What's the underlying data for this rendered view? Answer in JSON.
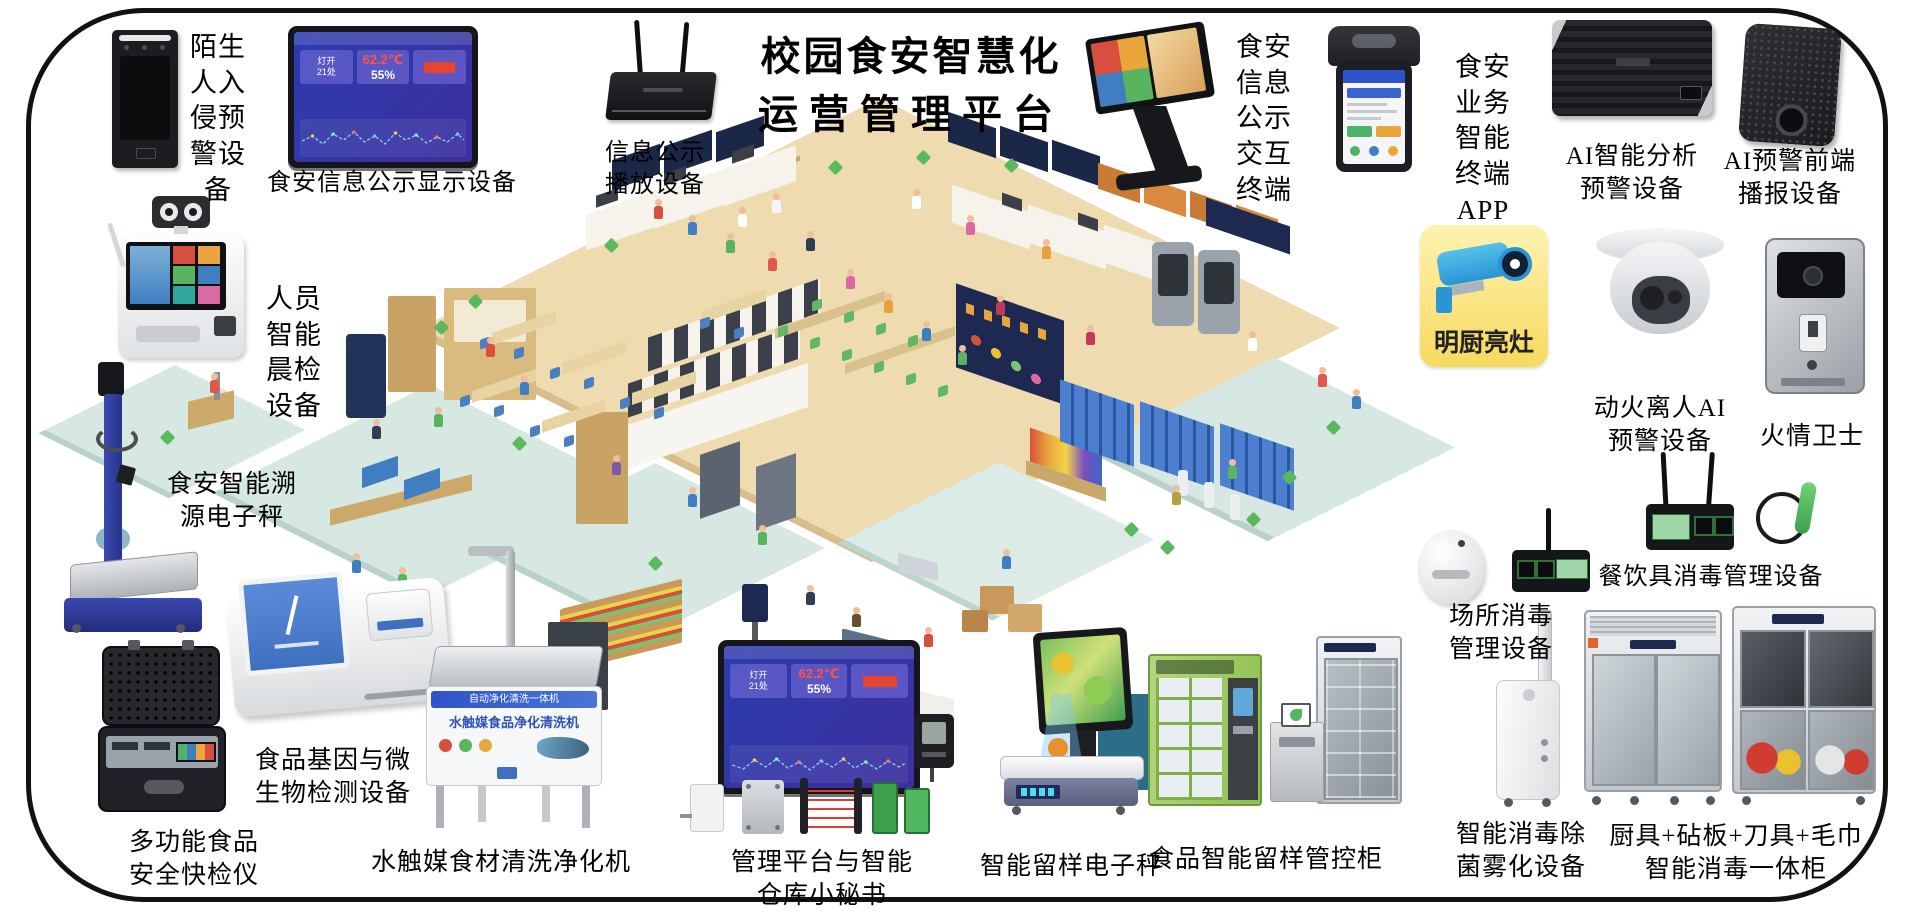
{
  "title": {
    "line1": "校园食安智慧化",
    "line2": "运营管理平台"
  },
  "dashboard": {
    "light_label": "灯开",
    "light_value": "21处",
    "temperature": "62.2℃",
    "humidity": "55%"
  },
  "washer_texts": {
    "strip": "自动净化清洗一体机",
    "banner": "水触媒食品净化清洗机"
  },
  "devices": {
    "stranger_alarm": {
      "label": "陌生\n人入\n侵预\n警设\n备"
    },
    "info_display": {
      "label": "食安信息公示显示设备"
    },
    "info_player": {
      "label": "信息公示\n播放设备"
    },
    "morning_check": {
      "label": "人员\n智能\n晨检\n设备"
    },
    "trace_scale": {
      "label": "食安智能溯\n源电子秤"
    },
    "gene_detector": {
      "label": "食品基因与微\n生物检测设备"
    },
    "quick_tester": {
      "label": "多功能食品\n安全快检仪"
    },
    "water_cleaner": {
      "label": "水触媒食材清洗净化机"
    },
    "info_kiosk": {
      "label": "食安\n信息\n公示\n交互\n终端"
    },
    "smart_terminal_app": {
      "label": "食安\n业务\n智能\n终端\nAPP"
    },
    "ai_analysis": {
      "label": "AI智能分析\n预警设备"
    },
    "ai_broadcast": {
      "label": "AI预警前端\n播报设备"
    },
    "bright_kitchen": {
      "label": "明厨亮灶"
    },
    "fire_leave_ai": {
      "label": "动火离人AI\n预警设备"
    },
    "fire_guard": {
      "label": "火情卫士"
    },
    "tableware_disinfect": {
      "label": "餐饮具消毒管理设备"
    },
    "site_disinfect": {
      "label": "场所消毒\n管理设备"
    },
    "fog_disinfect": {
      "label": "智能消毒除\n菌雾化设备"
    },
    "kitchen_tool_cabinet": {
      "label": "厨具+砧板+刀具+毛巾\n智能消毒一体柜"
    },
    "mgmt_platform": {
      "label": "管理平台与智能\n仓库小秘书"
    },
    "sample_scale": {
      "label": "智能留样电子秤"
    },
    "sample_cabinet": {
      "label": "食品智能留样管控柜"
    }
  }
}
